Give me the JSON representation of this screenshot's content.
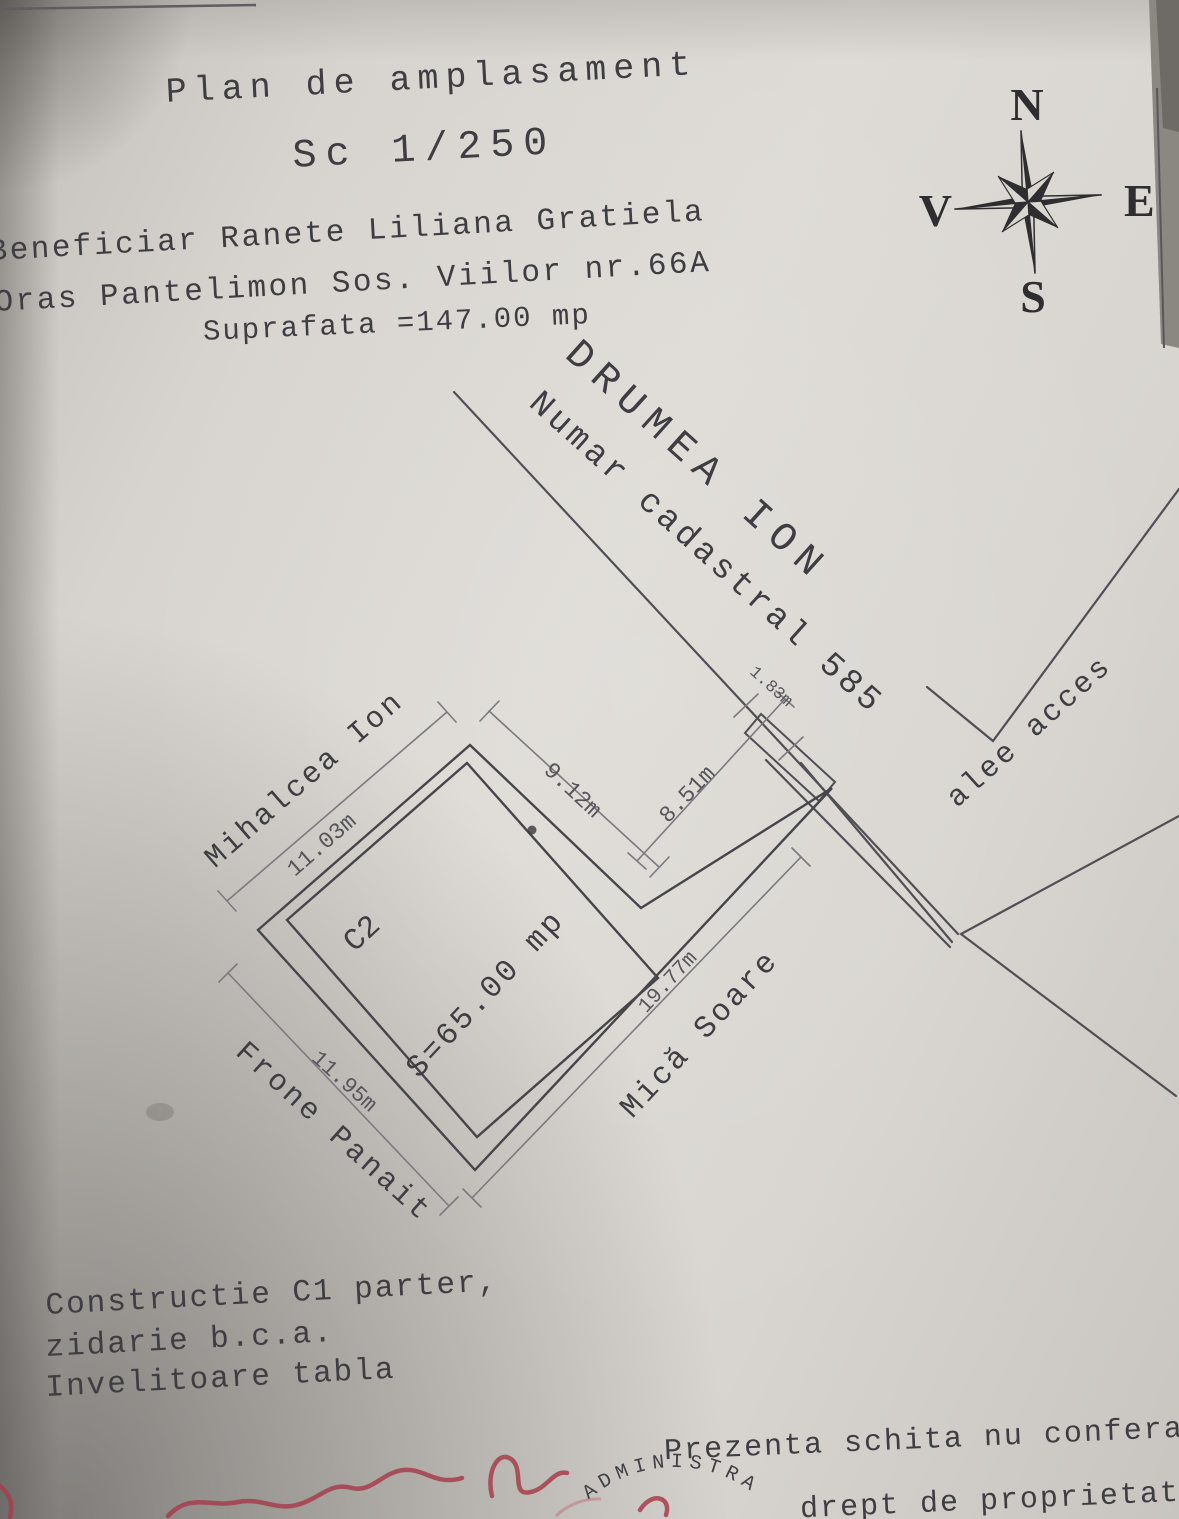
{
  "header": {
    "title": "Plan de amplasament",
    "scale": "Sc 1/250",
    "beneficiary": "Beneficiar Ranete Liliana Gratiela",
    "address": "Oras Pantelimon  Sos. Viilor nr.66A",
    "area": "Suprafata =147.00 mp"
  },
  "compass": {
    "n": "N",
    "e": "E",
    "s": "S",
    "v": "V"
  },
  "plan": {
    "road_owner": "DRUMEA ION",
    "road_cadastral": "Numar cadastral 585",
    "neighbor_left": "Mihalcea Ion",
    "neighbor_bottom": "Frone Panait",
    "neighbor_right": "Mică Soare",
    "access_label": "alee acces",
    "building_label": "C2",
    "building_area": "S=65.00 mp",
    "dims": {
      "left": "11.03m",
      "top_a": "9.12m",
      "top_b": "8.51m",
      "strip": "1.83m",
      "bottom": "11.95m",
      "right": "19.77m"
    }
  },
  "notes": {
    "construction_1": "Constructie C1 parter,",
    "construction_2": "zidarie b.c.a.",
    "construction_3": "Invelitoare tabla",
    "disclaimer_1": "Prezenta schita nu confera",
    "disclaimer_2": "drept de proprietate"
  },
  "stamp": {
    "arc_text": "ADMINISTRA"
  },
  "colors": {
    "ink": "#3e3d41",
    "line": "#504f54",
    "dim_line": "#7b7a7f",
    "red": "#a43e4c",
    "paper": "#d7d4cf"
  }
}
